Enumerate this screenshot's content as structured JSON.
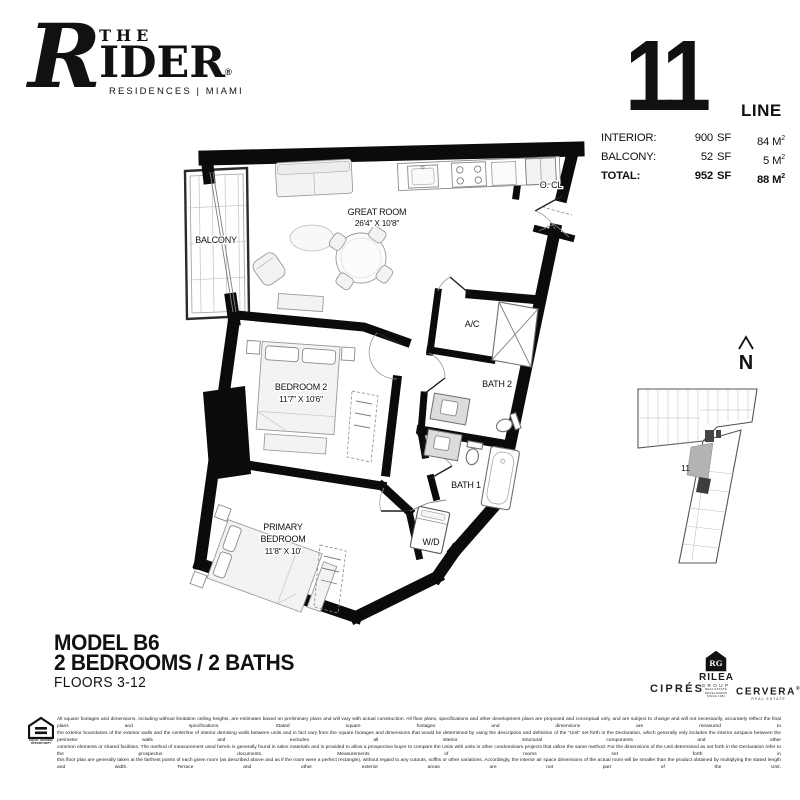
{
  "brand": {
    "initial": "R",
    "the": "THE",
    "name_rest": "IDER",
    "registered": "®",
    "tagline": "RESIDENCES | MIAMI"
  },
  "unit_header": {
    "number": "11",
    "line_label": "LINE"
  },
  "areas": {
    "rows": [
      {
        "label": "INTERIOR:",
        "sf_value": "900",
        "sf_unit": "SF",
        "m2_value": "84",
        "m2_unit": "M",
        "m2_sup": "2"
      },
      {
        "label": "BALCONY:",
        "sf_value": "52",
        "sf_unit": "SF",
        "m2_value": "5",
        "m2_unit": "M",
        "m2_sup": "2"
      },
      {
        "label": "TOTAL:",
        "sf_value": "952",
        "sf_unit": "SF",
        "m2_value": "88",
        "m2_unit": "M",
        "m2_sup": "2"
      }
    ]
  },
  "plan": {
    "balcony": "BALCONY",
    "great_room_name": "GREAT ROOM",
    "great_room_dims": "26'4\" X 10'8\"",
    "entry_closet": "O. CL",
    "ac_closet": "A/C",
    "bath2": "BATH 2",
    "bath1": "BATH 1",
    "bedroom2_name": "BEDROOM 2",
    "bedroom2_dims": "11'7\" X 10'6\"",
    "primary_name_line1": "PRIMARY",
    "primary_name_line2": "BEDROOM",
    "primary_dims": "11'8\" X 10'",
    "washer_dryer": "W/D"
  },
  "keyplan": {
    "unit_label": "11",
    "north_label": "N"
  },
  "model": {
    "title": "MODEL B6",
    "subtitle": "2 BEDROOMS / 2 BATHS",
    "floors": "FLOORS 3-12"
  },
  "footer_logos": {
    "cipres": "CIPRÉS",
    "rilea_monogram": "RG",
    "rilea_name": "RILEA",
    "rilea_group": "GROUP",
    "rilea_tagline1": "REAL ESTATE DEVELOPERS",
    "rilea_tagline2": "SINCE 1981",
    "cervera": "CERVERA",
    "cervera_registered": "®",
    "cervera_tagline": "REAL ESTATE"
  },
  "equal_housing": {
    "line1": "EQUAL HOUSING",
    "line2": "OPPORTUNITY"
  },
  "disclaimer": {
    "lines": [
      "All square footages and dimensions, including without limitation ceiling heights, are estimates based on preliminary plans and will vary with actual construction. All floor plans, specifications and other development plans are proposed and conceptual only, and are subject to change and will not necessarily, accurately reflect the final plans and specifications. Stated square footages and dimensions are measured to",
      "the exterior boundaries of the exterior walls and the centerline of interior demising walls between units and in fact vary from the square footages and dimensions that would be determined by using the description and definition of the \"Unit\" set forth in the Declaration, which generally only includes the interior airspace between the perimeter walls and excludes all interior structural components and other",
      "common elements or shared facilities. The method of measurement used herein is generally found in sales materials and is provided to allow a prospective buyer to compare the Units with units in other condominium projects that utilize the same method. For the dimensions of the Unit determined as set forth in the Declaration refer to the prospectus documents. Measurements of rooms set forth in",
      "this floor plan are generally taken at the farthest points of each given room (as described above and as if the room were a perfect rectangle), without regard to any cutouts, soffits or other variations. Accordingly, the interior air space dimensions of the actual room will be smaller than the product obtained by multiplying the stated length and width. Terrace and other exterior areas are not part of the Unit."
    ]
  }
}
